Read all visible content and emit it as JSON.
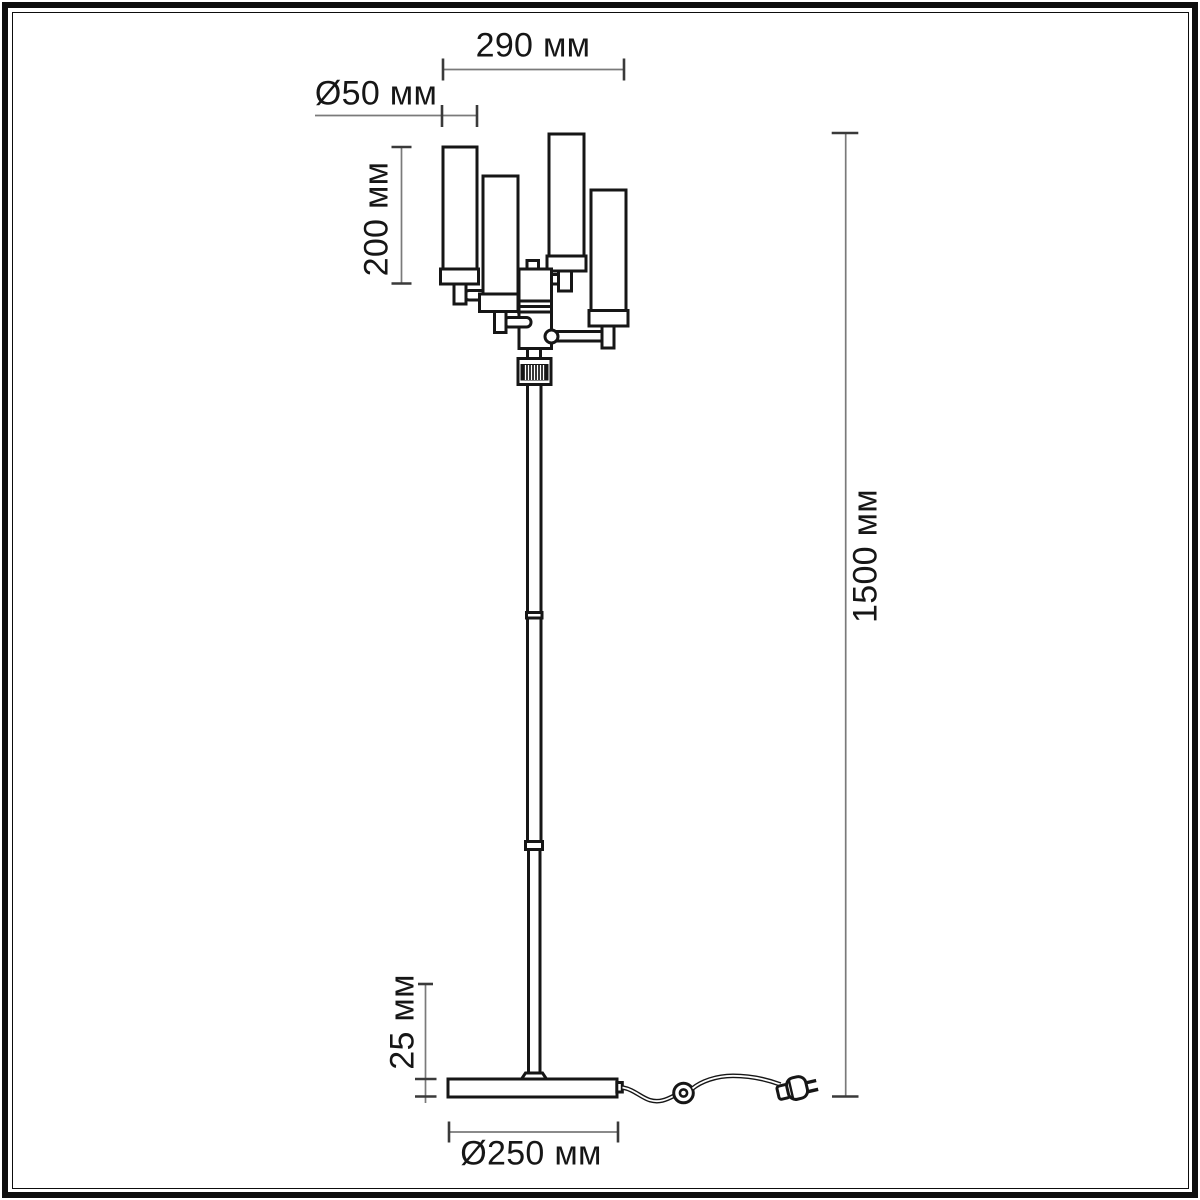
{
  "dimensions": {
    "head_width": "290 мм",
    "shade_diameter": "Ø50 мм",
    "shade_height": "200 мм",
    "total_height": "1500 мм",
    "base_thickness": "25 мм",
    "base_diameter": "Ø250 мм"
  },
  "colors": {
    "outline": "#161616",
    "dimension_line": "#7a7a7a",
    "tick": "#3a3a3a",
    "background": "#ffffff"
  }
}
